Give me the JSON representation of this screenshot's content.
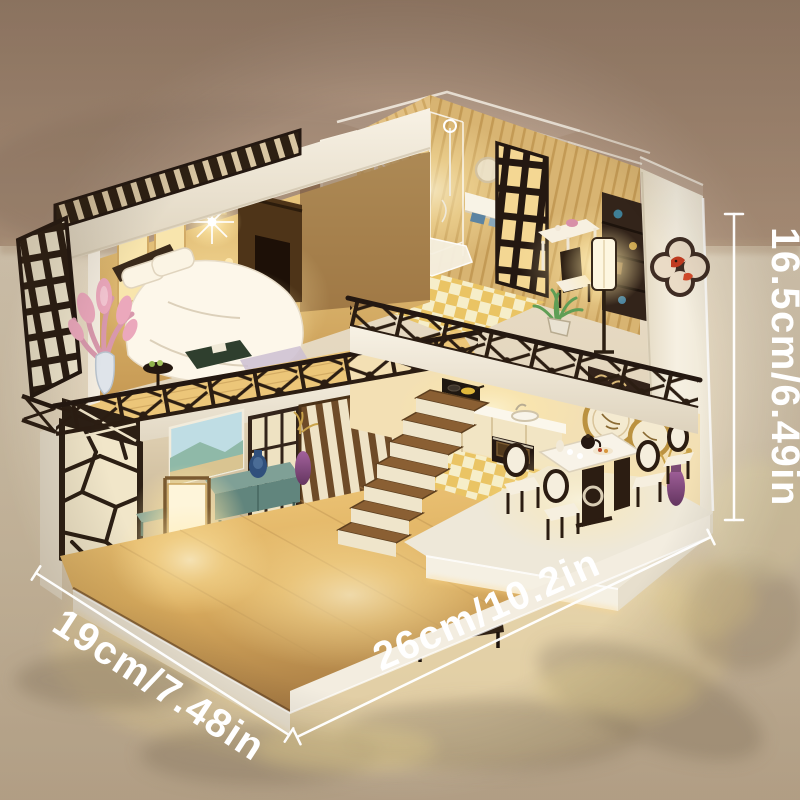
{
  "annotations": {
    "height": {
      "label": "16.5cm/6.49in"
    },
    "depth": {
      "label": "19cm/7.48in"
    },
    "width": {
      "label": "26cm/10.2in"
    }
  },
  "palette": {
    "background_wall": "#a78e7a",
    "background_surface": "#ddcfb6",
    "house_white": "#f4eddd",
    "warm_light": "#ffe9a8",
    "dark_wood": "#33241a",
    "mid_wood": "#c9a35e",
    "accent_teal": "#7fa096",
    "accent_pink": "#eba8bc",
    "accent_purple": "#8e4f78",
    "annotation_text": "#ffffff"
  }
}
